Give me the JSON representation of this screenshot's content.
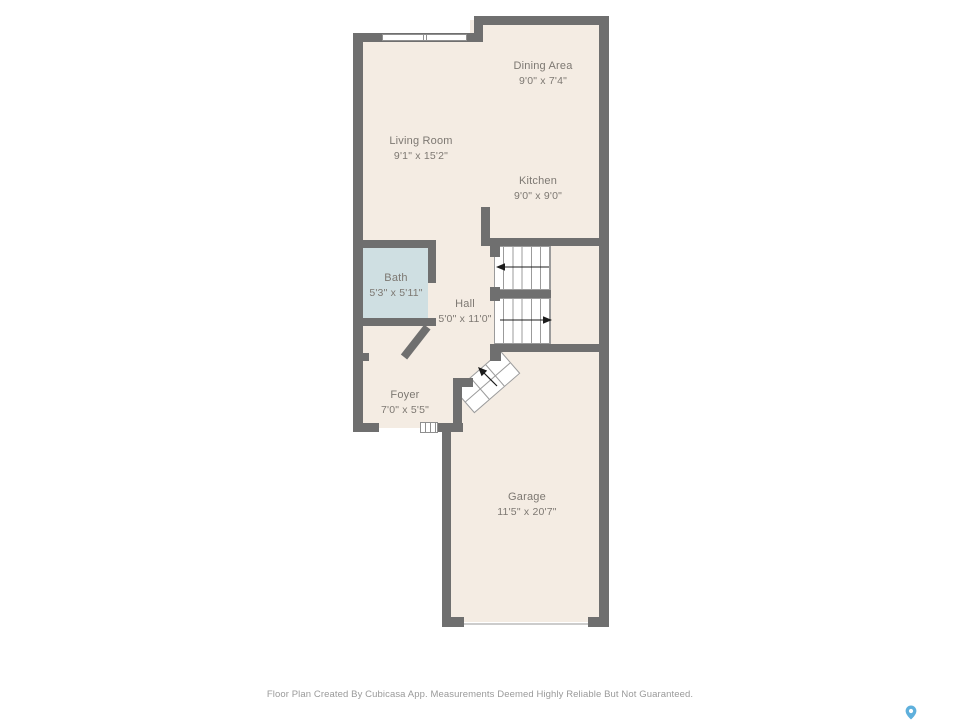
{
  "title": "Floor Plan",
  "colors": {
    "wall": "#6f6f6f",
    "floor": "#f4ece3",
    "bath-floor": "#cfdfe2",
    "stair-line": "#9b9b9b",
    "label-text": "#7d7872",
    "footer-text": "#9a9a9a",
    "pin-blue": "#5fb0dc",
    "arrow": "#1c1c1c",
    "page-bg": "#ffffff"
  },
  "rooms": {
    "dining": {
      "name": "Dining Area",
      "dims": "9'0\" x 7'4\""
    },
    "living": {
      "name": "Living Room",
      "dims": "9'1\" x 15'2\""
    },
    "kitchen": {
      "name": "Kitchen",
      "dims": "9'0\" x 9'0\""
    },
    "bath": {
      "name": "Bath",
      "dims": "5'3\" x 5'11\""
    },
    "hall": {
      "name": "Hall",
      "dims": "5'0\" x 11'0\""
    },
    "foyer": {
      "name": "Foyer",
      "dims": "7'0\" x 5'5\""
    },
    "garage": {
      "name": "Garage",
      "dims": "11'5\" x 20'7\""
    }
  },
  "symbols": {
    "window": "window-symbol",
    "entry_door": "entry-door-symbol",
    "garage_door": "garage-door-opening",
    "stair_arrow_upper": "stair-direction-arrow-left",
    "stair_arrow_lower": "stair-direction-arrow-right",
    "entry_steps_arrow": "entry-steps-arrow",
    "map_pin": "map-pin-icon"
  },
  "footer": {
    "disclaimer": "Floor Plan Created By Cubicasa App. Measurements Deemed Highly Reliable But Not Guaranteed."
  }
}
